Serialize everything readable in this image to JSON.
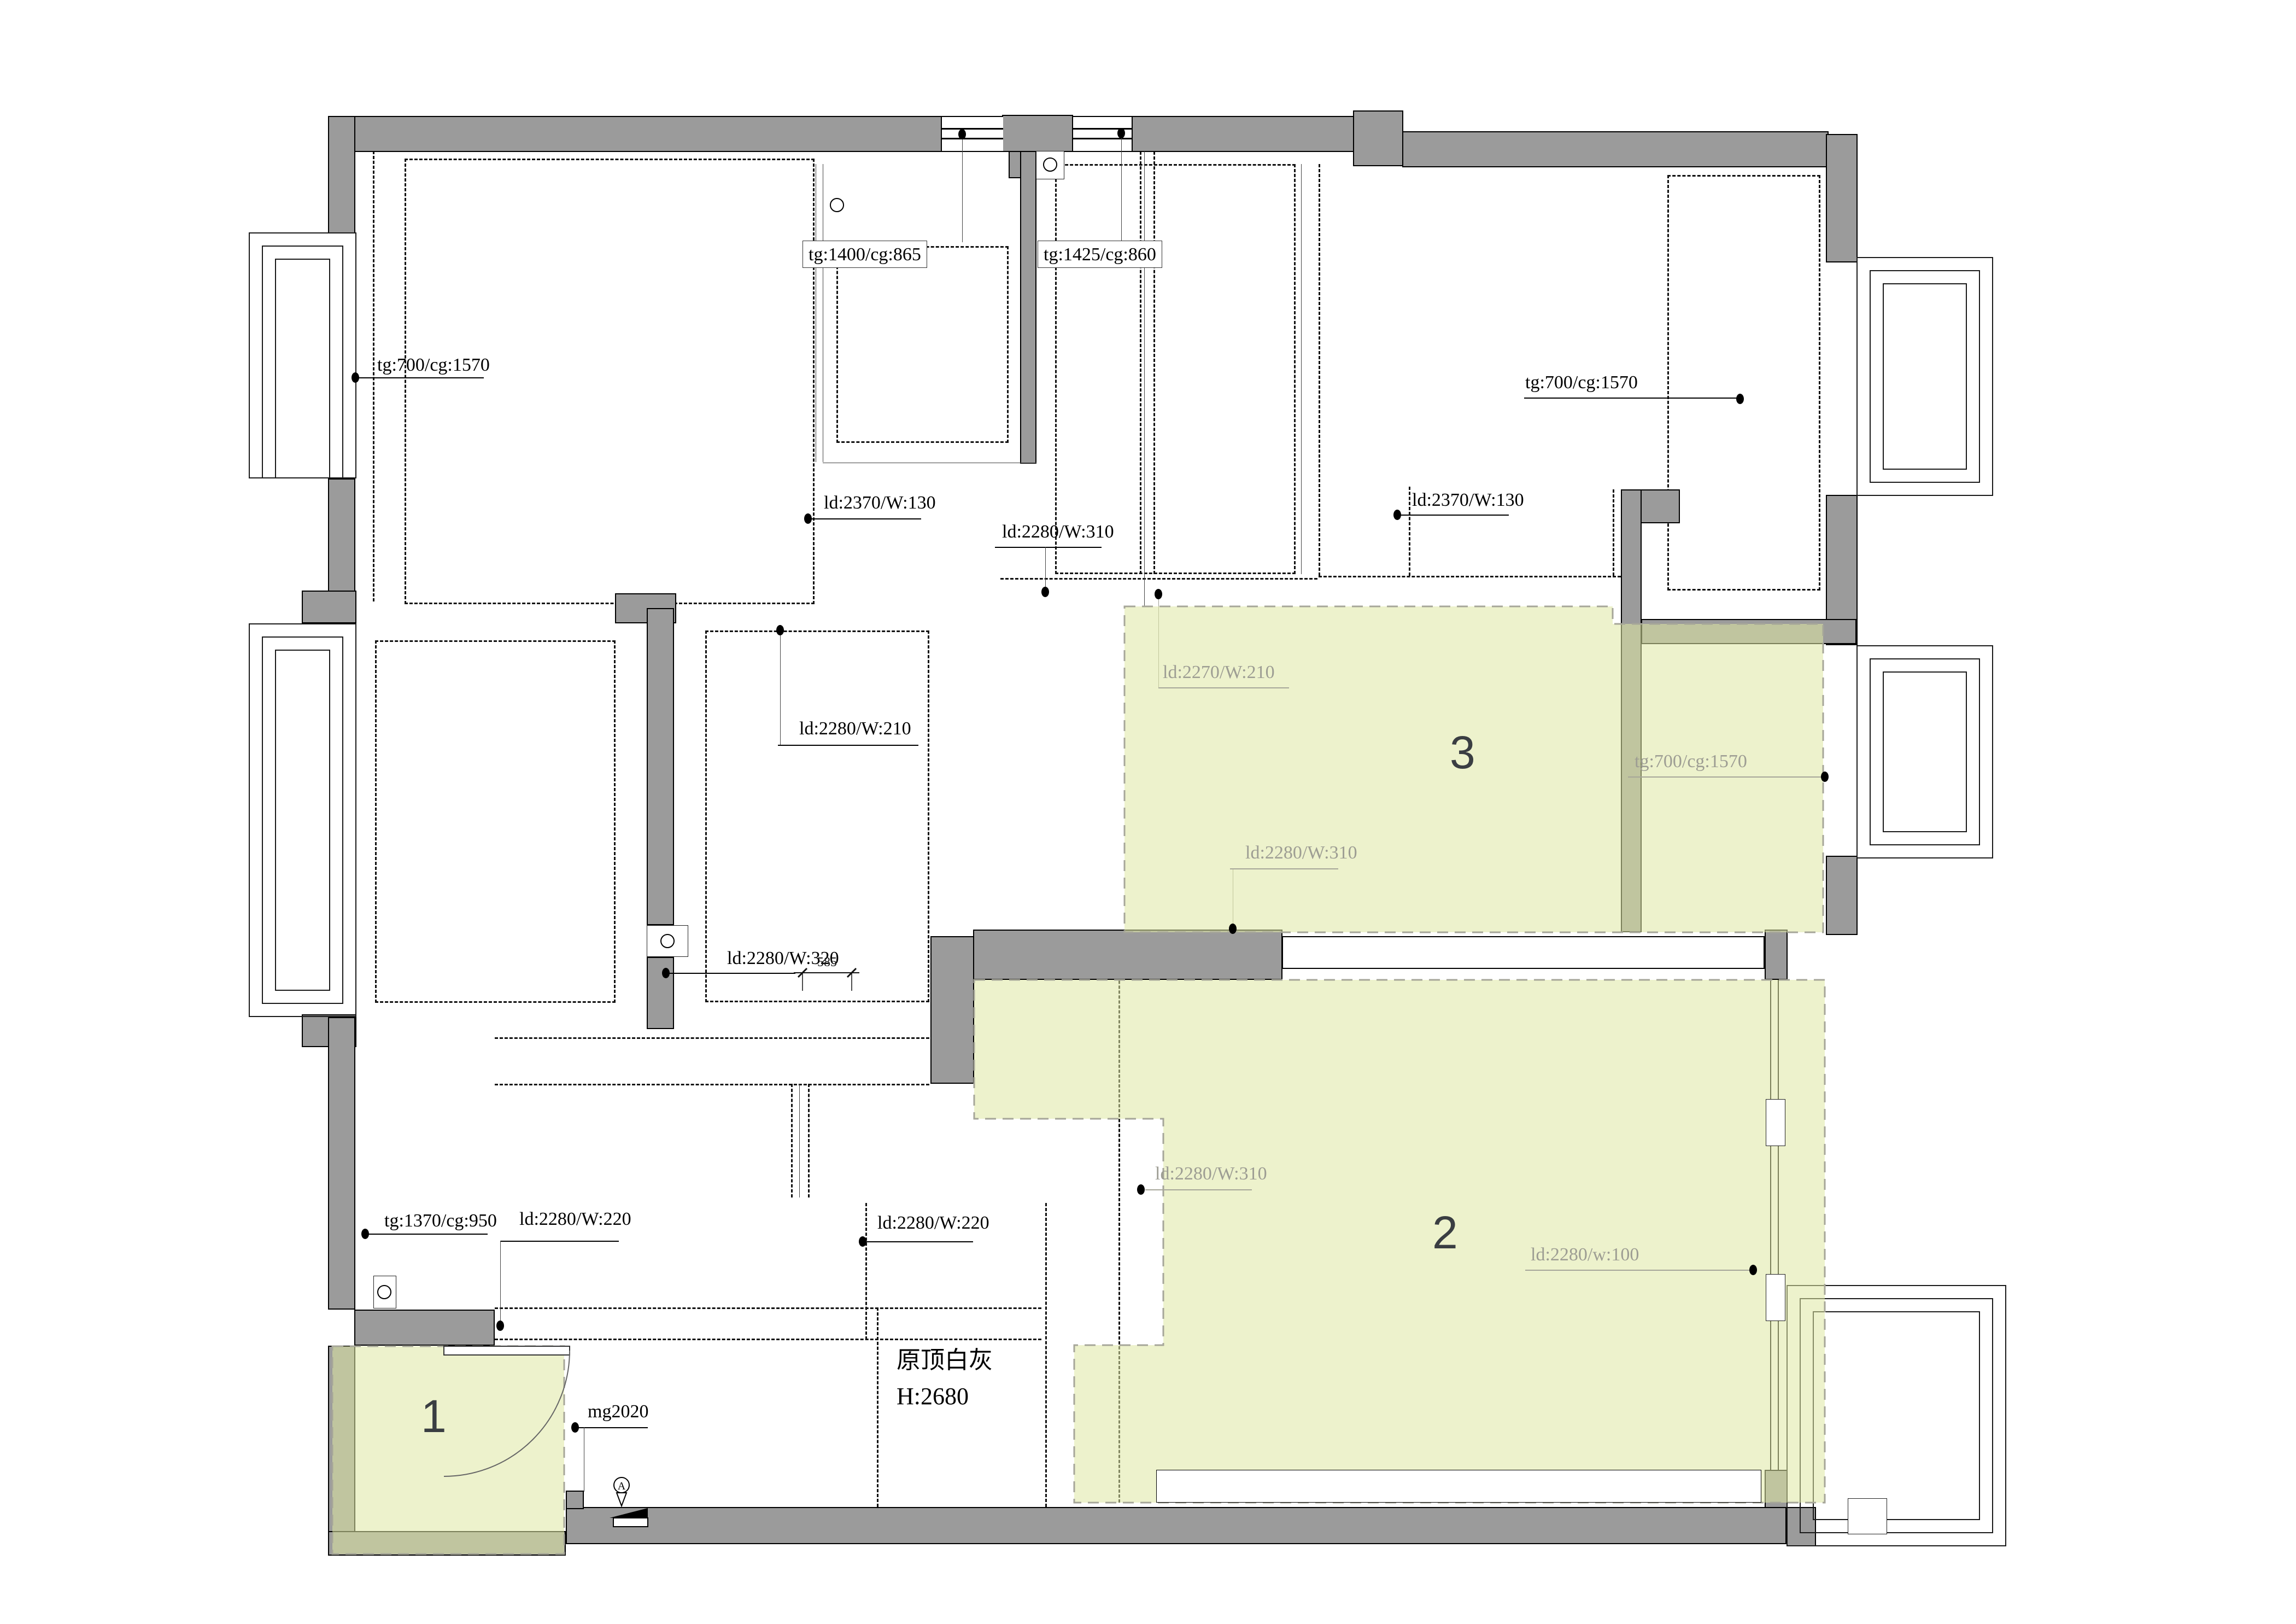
{
  "drawing": {
    "type": "ceiling-lighting-plan",
    "room_note": {
      "line1": "原顶白灰",
      "line2": "H:2680"
    },
    "dimension_585": "585"
  },
  "colors": {
    "wall_gray": "#9b9b9b",
    "highlight_yellow": "#eef3d0",
    "gray_label": "#9d9d93",
    "numeral": "#3a3e42"
  },
  "areas": [
    {
      "number": "1"
    },
    {
      "number": "2"
    },
    {
      "number": "3"
    }
  ],
  "labels": [
    {
      "id": "tl-ceiling",
      "text": "tg:700/cg:1570"
    },
    {
      "id": "top-win-left",
      "text": "tg:1400/cg:865"
    },
    {
      "id": "top-win-right",
      "text": "tg:1425/cg:860"
    },
    {
      "id": "ld-left",
      "text": "ld:2370/W:130"
    },
    {
      "id": "ld-top-mid",
      "text": "ld:2280/W:310"
    },
    {
      "id": "ld-right",
      "text": "ld:2370/W:130"
    },
    {
      "id": "tr-ceiling",
      "text": "tg:700/cg:1570"
    },
    {
      "id": "area3-ld-top",
      "text": "ld:2270/W:210"
    },
    {
      "id": "area3-ceiling",
      "text": "tg:700/cg:1570"
    },
    {
      "id": "area3-ld-bot",
      "text": "ld:2280/W:310"
    },
    {
      "id": "center-ld",
      "text": "ld:2280/W:210"
    },
    {
      "id": "center-ld2",
      "text": "ld:2280/W:320"
    },
    {
      "id": "area2-ld-left",
      "text": "ld:2280/W:310"
    },
    {
      "id": "area2-ld-right",
      "text": "ld:2280/w:100"
    },
    {
      "id": "bl-ceiling",
      "text": "tg:1370/cg:950"
    },
    {
      "id": "corr-ld-left",
      "text": "ld:2280/W:220"
    },
    {
      "id": "corr-ld-right",
      "text": "ld:2280/W:220"
    },
    {
      "id": "entry-door",
      "text": "mg2020"
    }
  ]
}
